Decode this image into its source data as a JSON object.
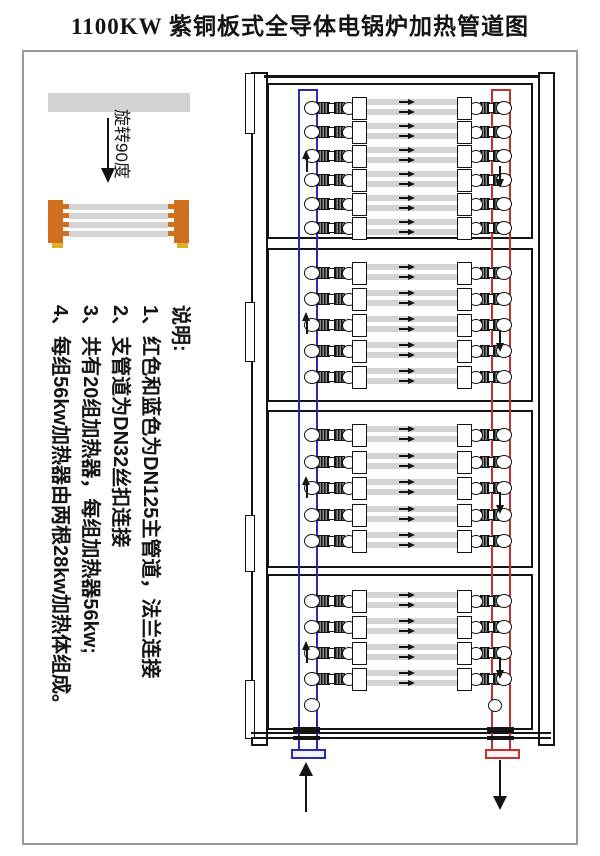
{
  "title": "1100KW 紫铜板式全导体电锅炉加热管道图",
  "legend": {
    "rotation_label": "旋转90度",
    "element_colors": {
      "copper_end_block": "#cf6f1f",
      "foot_yellow": "#dfb226",
      "tube_gray": "#d3d3d3"
    }
  },
  "notes": {
    "heading": "说明:",
    "items": [
      "1、红色和蓝色为DN125主管道，法兰连接",
      "2、支管道为DN32丝扣连接",
      "3、共有20组加热器，每组加热器56kw;",
      "4、每组56kw加热器由两根28kw加热体组成。"
    ]
  },
  "diagram": {
    "total_heater_groups": 20,
    "tubes_per_group": 2,
    "sections": [
      {
        "heater_groups": 6
      },
      {
        "heater_groups": 5
      },
      {
        "heater_groups": 5
      },
      {
        "heater_groups": 4,
        "spare_caps": true
      }
    ],
    "flow": {
      "left_pipe": "up",
      "right_pipe": "down",
      "tubes": "right"
    },
    "colors": {
      "main_pipe_blue": "#2a2ab0",
      "main_pipe_red": "#c23030",
      "tube_gray": "#d3d3d3"
    }
  }
}
